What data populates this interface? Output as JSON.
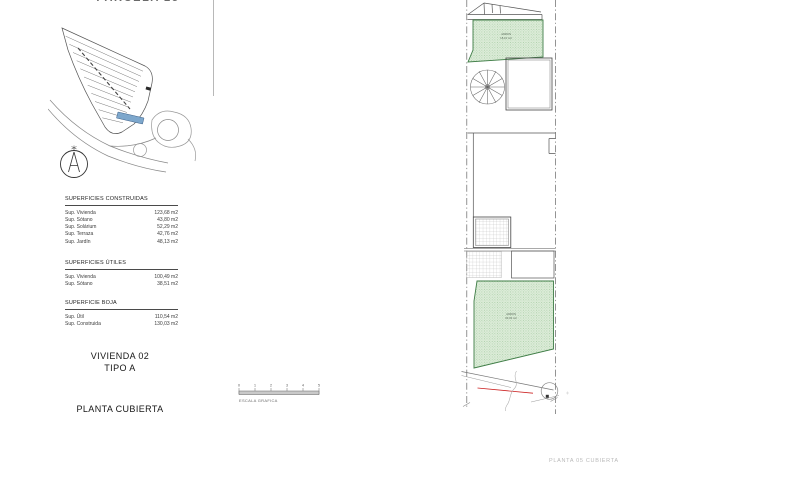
{
  "header": {
    "parcel_title": "PARCELA 25"
  },
  "area_tables": {
    "constructed": {
      "header": "SUPERFICIES CONSTRUIDAS",
      "rows": [
        {
          "label": "Sup. Vivienda",
          "value": "123,68 m2"
        },
        {
          "label": "Sup. Sótano",
          "value": "43,80 m2"
        },
        {
          "label": "Sup. Solárium",
          "value": "52,29 m2"
        },
        {
          "label": "Sup. Terraza",
          "value": "42,76 m2"
        },
        {
          "label": "Sup. Jardín",
          "value": "48,13 m2"
        }
      ]
    },
    "useful": {
      "header": "SUPERFICIES ÚTILES",
      "rows": [
        {
          "label": "Sup. Vivienda",
          "value": "100,49 m2"
        },
        {
          "label": "Sup. Sótano",
          "value": "38,51 m2"
        }
      ]
    },
    "boja": {
      "header": "SUPERFICIE BOJA",
      "rows": [
        {
          "label": "Sup. Útil",
          "value": "110,54 m2"
        },
        {
          "label": "Sup. Construida",
          "value": "130,03 m2"
        }
      ]
    }
  },
  "titles": {
    "dwelling": "VIVIENDA 02",
    "type": "TIPO A",
    "plan": "PLANTA CUBIERTA"
  },
  "scale_bar": {
    "label": "ESCALA GRAFICA",
    "ticks": [
      "0",
      "1",
      "2",
      "3",
      "4",
      "5"
    ]
  },
  "floor_plan": {
    "garden_top": {
      "label": "JARDIN",
      "area": "18,10 m2"
    },
    "garden_bottom": {
      "label": "JARDIN",
      "area": "30,03 m2"
    }
  },
  "footer": {
    "sheet_label": "PLANTA 05 CUBIERTA"
  },
  "colors": {
    "garden_stroke": "#3f7d46",
    "parcel_highlight": "#7da7cc",
    "red_line": "#cc2222"
  }
}
